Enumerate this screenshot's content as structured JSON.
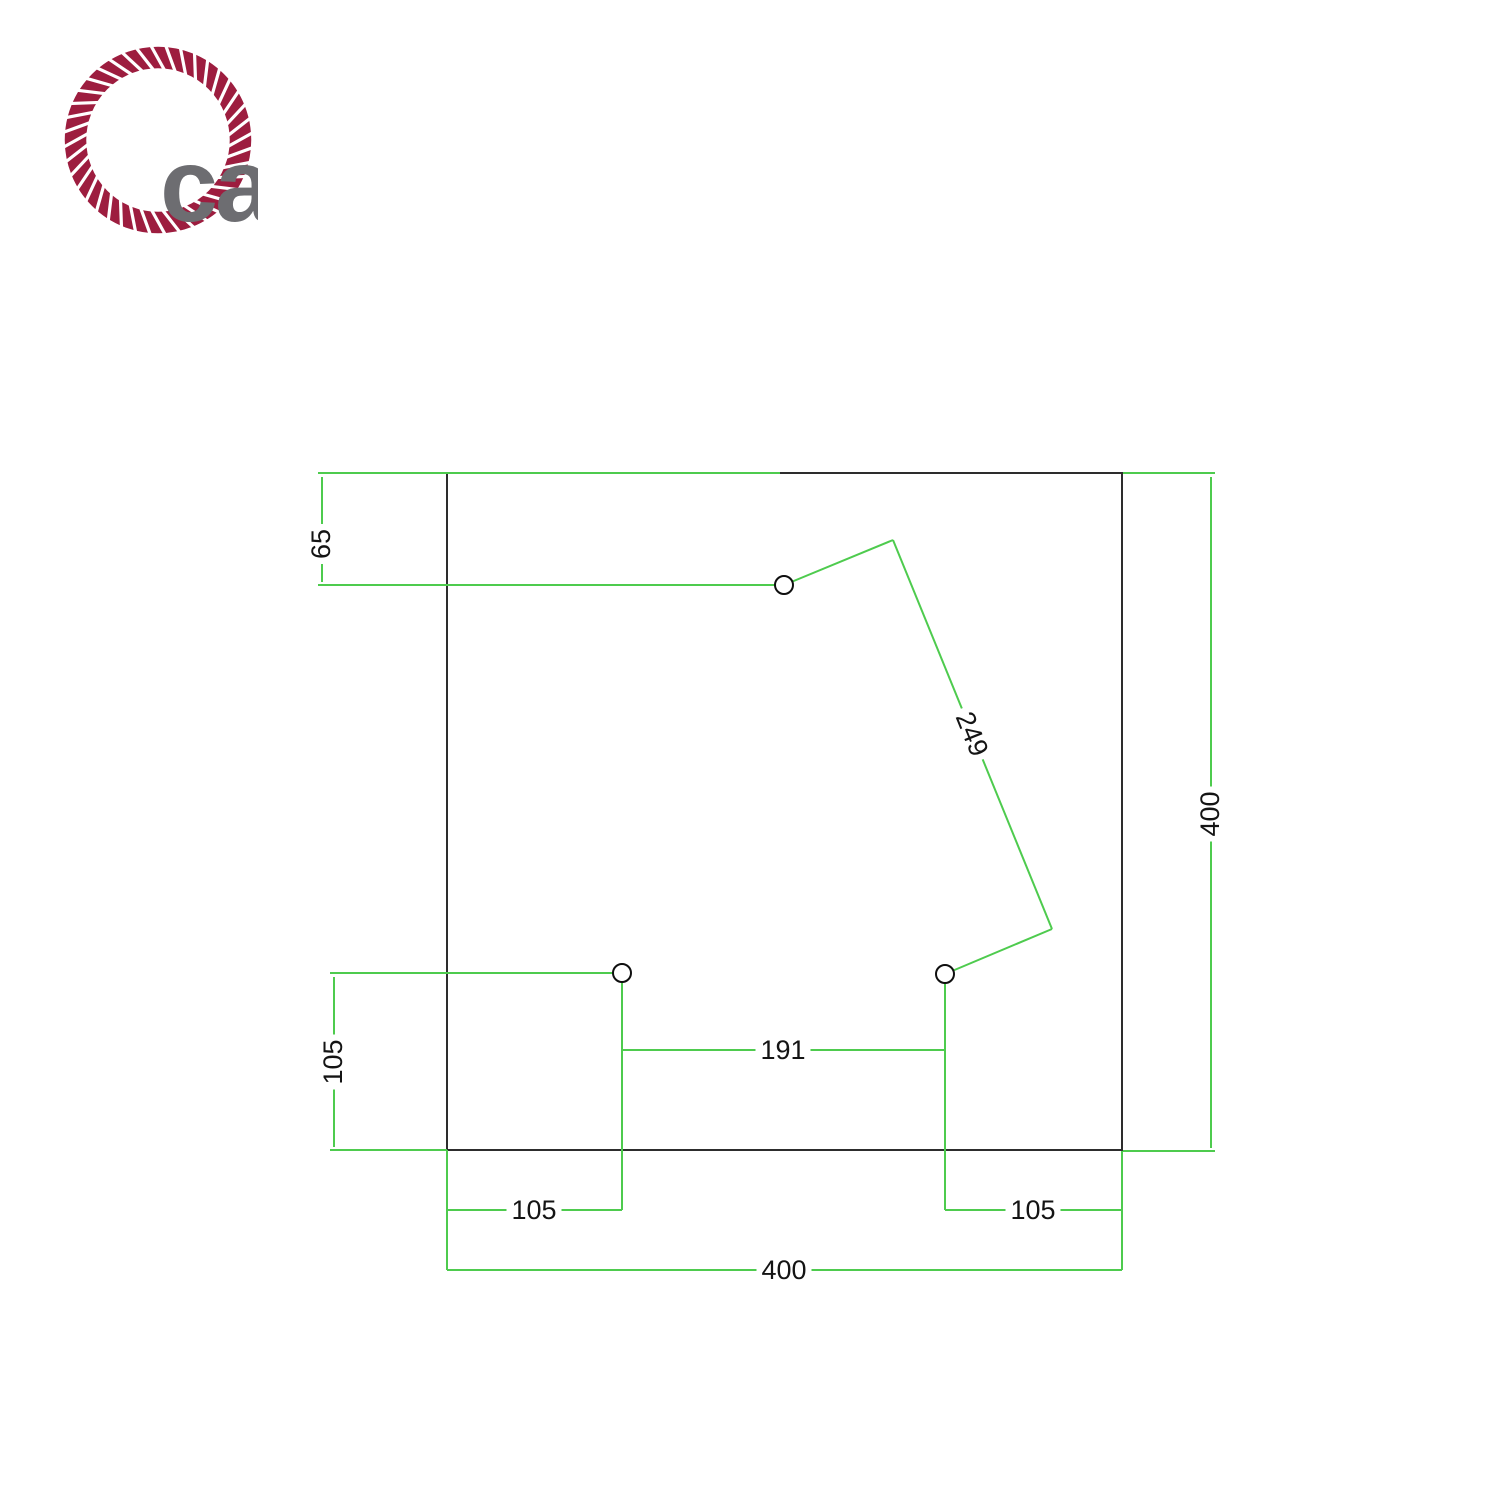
{
  "brand": {
    "logo_text": "ca",
    "rope_color": "#9d1d3f",
    "letter_color": "#6d6d71"
  },
  "drawing": {
    "line_color": "#4ecb4e",
    "outline_color": "#2d2d2d",
    "label_color": "#141414",
    "plate": {
      "x": 447,
      "y": 473,
      "w": 675,
      "h": 677,
      "size_mm": 400
    },
    "holes": [
      {
        "cx": 784,
        "cy": 585,
        "r": 9
      },
      {
        "cx": 622,
        "cy": 973,
        "r": 9
      },
      {
        "cx": 945,
        "cy": 974,
        "r": 9
      }
    ],
    "segments": [
      {
        "name": "extension-line",
        "x1": 318,
        "y1": 473,
        "x2": 780,
        "y2": 473
      },
      {
        "name": "extension-line",
        "x1": 318,
        "y1": 585,
        "x2": 784,
        "y2": 585
      },
      {
        "name": "dimension-line",
        "x1": 322,
        "y1": 477,
        "x2": 322,
        "y2": 582
      },
      {
        "name": "leader-line",
        "x1": 784,
        "y1": 585,
        "x2": 893,
        "y2": 540
      },
      {
        "name": "dimension-line",
        "x1": 893,
        "y1": 540,
        "x2": 1052,
        "y2": 929
      },
      {
        "name": "leader-line",
        "x1": 1052,
        "y1": 929,
        "x2": 945,
        "y2": 974
      },
      {
        "name": "extension-line",
        "x1": 330,
        "y1": 973,
        "x2": 622,
        "y2": 973
      },
      {
        "name": "dimension-line",
        "x1": 334,
        "y1": 977,
        "x2": 334,
        "y2": 1147
      },
      {
        "name": "extension-line",
        "x1": 330,
        "y1": 1150,
        "x2": 447,
        "y2": 1150
      },
      {
        "name": "extension-line",
        "x1": 622,
        "y1": 973,
        "x2": 622,
        "y2": 1210
      },
      {
        "name": "extension-line",
        "x1": 945,
        "y1": 974,
        "x2": 945,
        "y2": 1210
      },
      {
        "name": "dimension-line",
        "x1": 622,
        "y1": 1050,
        "x2": 945,
        "y2": 1050
      },
      {
        "name": "dimension-line",
        "x1": 447,
        "y1": 1210,
        "x2": 622,
        "y2": 1210
      },
      {
        "name": "dimension-line",
        "x1": 945,
        "y1": 1210,
        "x2": 1122,
        "y2": 1210
      },
      {
        "name": "extension-line",
        "x1": 447,
        "y1": 1150,
        "x2": 447,
        "y2": 1270
      },
      {
        "name": "extension-line",
        "x1": 1122,
        "y1": 1151,
        "x2": 1122,
        "y2": 1270
      },
      {
        "name": "dimension-line",
        "x1": 447,
        "y1": 1270,
        "x2": 1122,
        "y2": 1270
      },
      {
        "name": "extension-line",
        "x1": 1123,
        "y1": 473,
        "x2": 1215,
        "y2": 473
      },
      {
        "name": "dimension-line",
        "x1": 1211,
        "y1": 477,
        "x2": 1211,
        "y2": 1148
      },
      {
        "name": "extension-line",
        "x1": 1123,
        "y1": 1151,
        "x2": 1215,
        "y2": 1151
      }
    ],
    "labels": [
      {
        "text": "65",
        "x": 321,
        "y": 544,
        "rotate": -90
      },
      {
        "text": "249",
        "x": 972,
        "y": 734,
        "rotate": 68
      },
      {
        "text": "400",
        "x": 1210,
        "y": 814,
        "rotate": -90
      },
      {
        "text": "105",
        "x": 333,
        "y": 1062,
        "rotate": -90
      },
      {
        "text": "191",
        "x": 783,
        "y": 1050,
        "rotate": 0
      },
      {
        "text": "105",
        "x": 534,
        "y": 1210,
        "rotate": 0
      },
      {
        "text": "105",
        "x": 1033,
        "y": 1210,
        "rotate": 0
      },
      {
        "text": "400",
        "x": 784,
        "y": 1270,
        "rotate": 0
      }
    ],
    "dimensions_mm": {
      "plate_width": 400,
      "plate_height": 400,
      "hole1_offset_from_top": 65,
      "hole1_to_hole3_distance": 249,
      "hole2_offset_from_bottom": 105,
      "hole2_offset_from_left": 105,
      "hole3_offset_from_right": 105,
      "hole2_to_hole3_distance": 191
    }
  }
}
